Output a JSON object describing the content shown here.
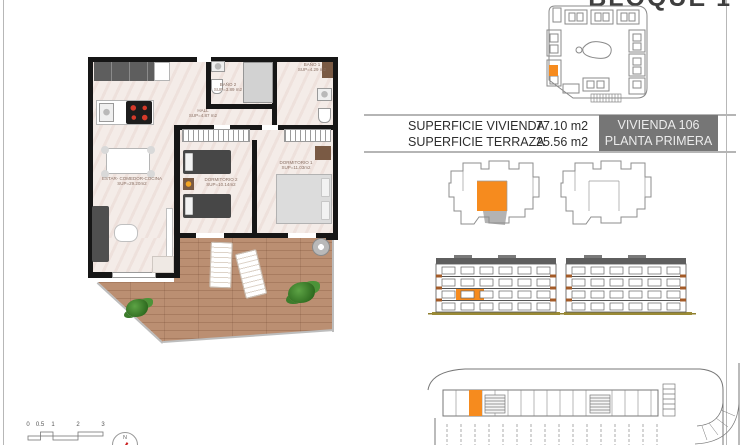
{
  "page": {
    "title": "BLOQUE 1"
  },
  "summary": {
    "rows": [
      {
        "label": "SUPERFICIE VIVIENDA",
        "value": "77.10 m2"
      },
      {
        "label": "SUPERFICIE TERRAZA",
        "value": "25.56 m2"
      }
    ],
    "badge": {
      "line1": "VIVIENDA 106",
      "line2": "PLANTA PRIMERA"
    }
  },
  "floor_plan": {
    "rooms": [
      {
        "name": "ESTAR- COMEDOR-COCINA",
        "area": "SUP=29.20m2"
      },
      {
        "name": "HALL",
        "area": "SUP=4.87 m2"
      },
      {
        "name": "BAÑO 2",
        "area": "SUP=3.89 m2"
      },
      {
        "name": "BAÑO 1",
        "area": "SUP=4.29 m2"
      },
      {
        "name": "DORMITORIO 2",
        "area": "SUP=10.14m2"
      },
      {
        "name": "DORMITORIO 1",
        "area": "SUP=11.03m2"
      }
    ]
  },
  "scale_bar": {
    "ticks": [
      "0",
      "0.5",
      "1",
      "2",
      "3"
    ]
  },
  "north": {
    "label": "N"
  },
  "colors": {
    "accent_orange": "#F68B1E",
    "badge_gray": "#767676"
  }
}
